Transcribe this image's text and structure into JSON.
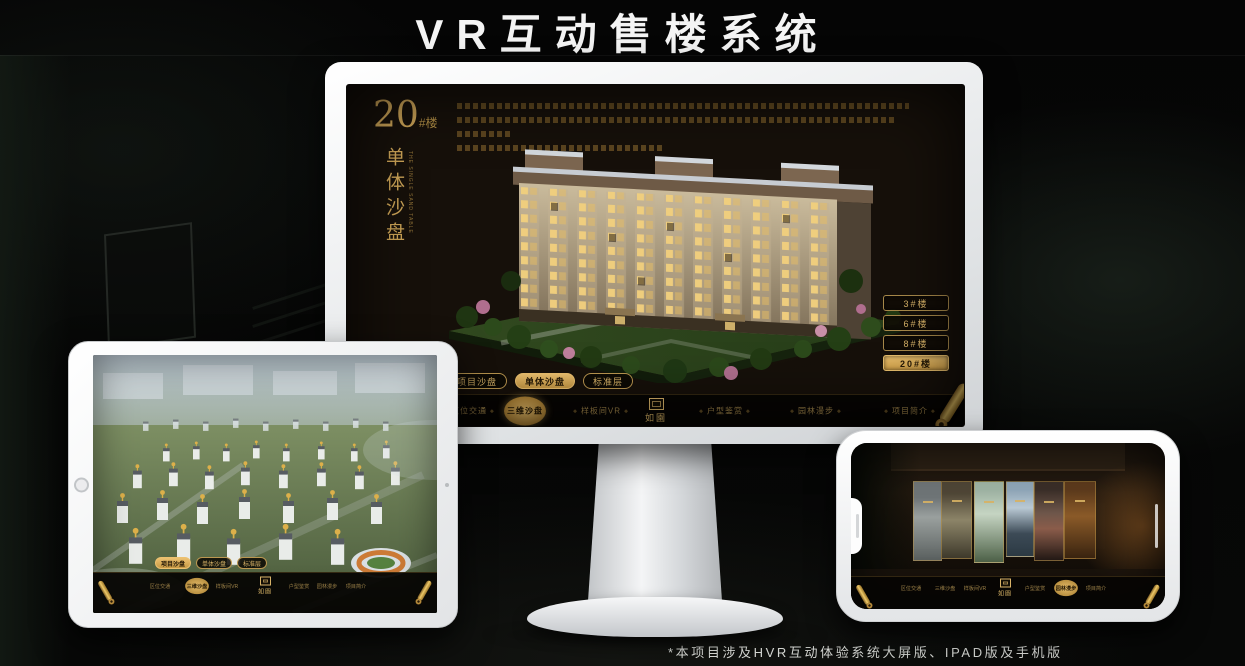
{
  "page": {
    "title": "VR互动售楼系统",
    "footnote": "*本项目涉及HVR互动体验系统大屏版、IPAD版及手机版"
  },
  "colors": {
    "gold": "#c9a155",
    "gold_bright": "#e2b968",
    "screen_bg": "#16100a"
  },
  "monitor": {
    "headline": {
      "number": "20",
      "suffix": "#楼",
      "vertical_title": "单体沙盘",
      "vertical_subtitle": "THE SINGLE SAND TABLE"
    },
    "floor_buttons": [
      {
        "label": "3#楼",
        "active": false
      },
      {
        "label": "6#楼",
        "active": false
      },
      {
        "label": "8#楼",
        "active": false
      },
      {
        "label": "20#楼",
        "active": true
      }
    ],
    "sub_tabs": [
      {
        "label": "项目沙盘",
        "active": false
      },
      {
        "label": "单体沙盘",
        "active": true
      },
      {
        "label": "标准层",
        "active": false
      }
    ],
    "nav_items": [
      {
        "label": "区位交通",
        "active": false
      },
      {
        "label": "三维沙盘",
        "active": true
      },
      {
        "label": "样板间VR",
        "active": false
      },
      {
        "label": "户型鉴赏",
        "active": false
      },
      {
        "label": "园林漫步",
        "active": false
      },
      {
        "label": "项目简介",
        "active": false
      }
    ],
    "logo": "如園"
  },
  "tablet": {
    "sub_tabs": [
      {
        "label": "项目沙盘",
        "active": true
      },
      {
        "label": "单体沙盘",
        "active": false
      },
      {
        "label": "标准层",
        "active": false
      }
    ],
    "nav_items": [
      {
        "label": "区位交通",
        "active": false
      },
      {
        "label": "三维沙盘",
        "active": true
      },
      {
        "label": "样板间VR",
        "active": false
      },
      {
        "label": "户型鉴赏",
        "active": false
      },
      {
        "label": "园林漫步",
        "active": false
      },
      {
        "label": "项目简介",
        "active": false
      }
    ],
    "logo": "如園"
  },
  "phone": {
    "nav_items": [
      {
        "label": "区位交通",
        "active": false
      },
      {
        "label": "三维沙盘",
        "active": false
      },
      {
        "label": "样板间VR",
        "active": false
      },
      {
        "label": "户型鉴赏",
        "active": false
      },
      {
        "label": "园林漫步",
        "active": true
      },
      {
        "label": "项目简介",
        "active": false
      }
    ],
    "logo": "如園"
  }
}
